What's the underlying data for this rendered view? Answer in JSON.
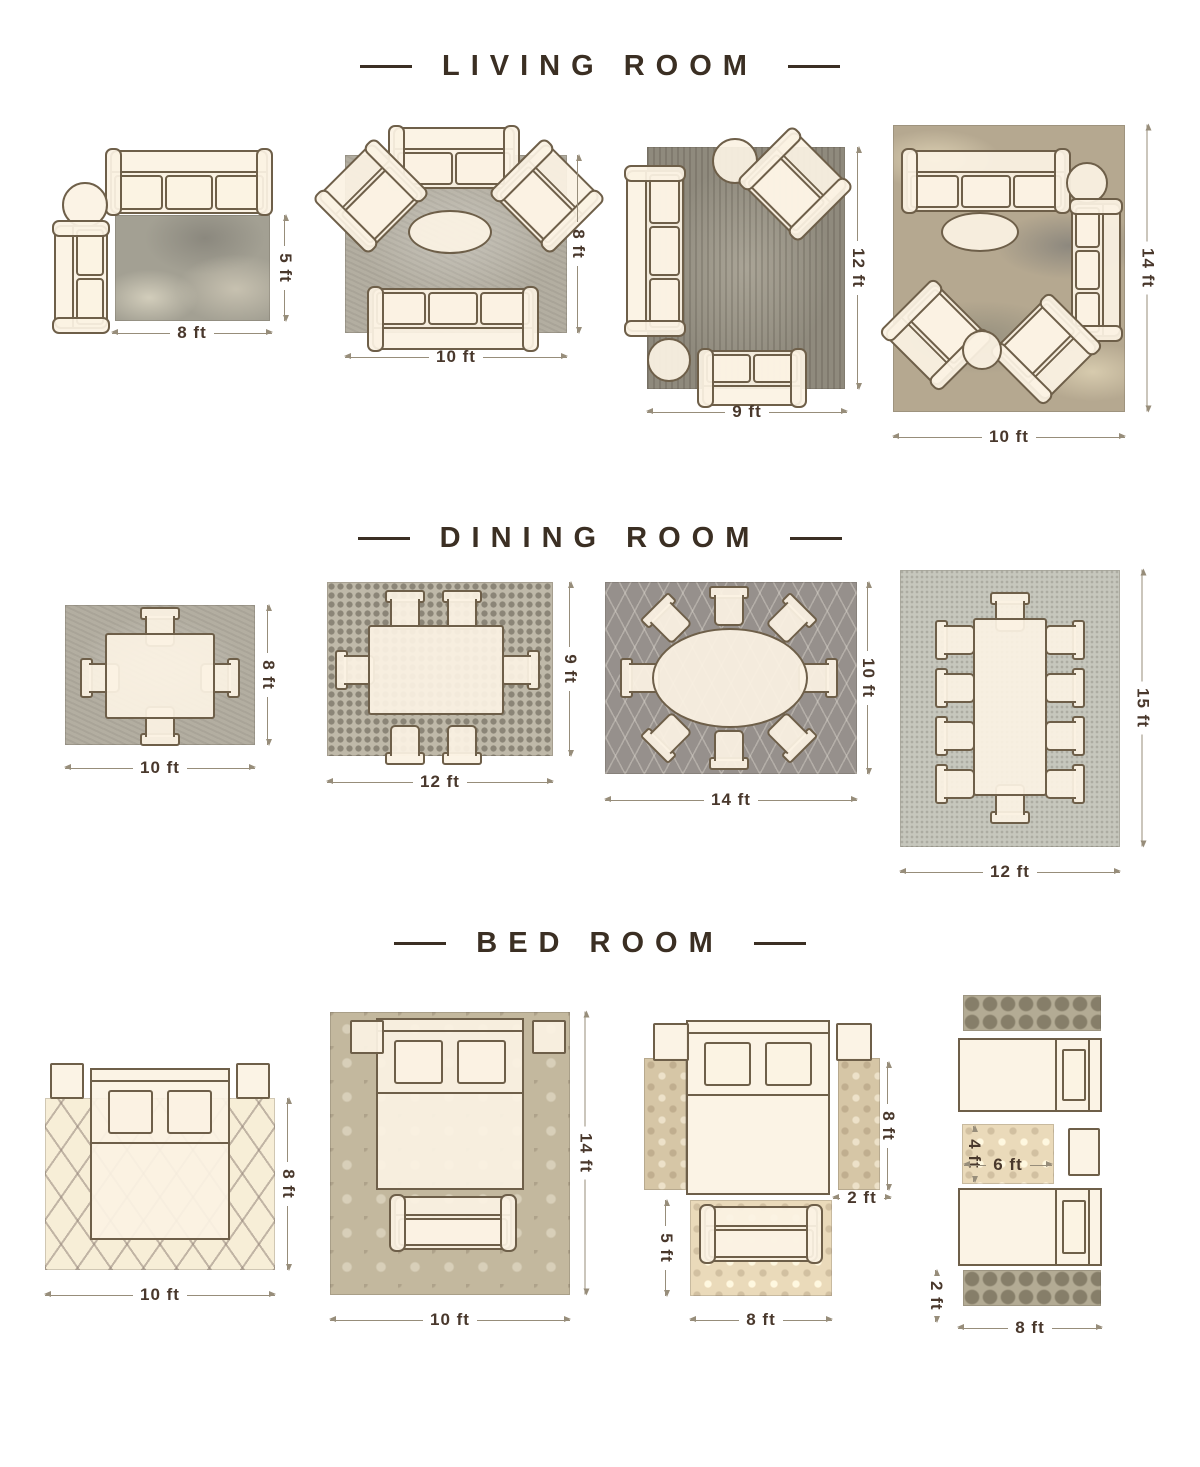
{
  "title": "Rug size guide",
  "colors": {
    "furniture_outline": "#6e5f49",
    "furniture_fill": "#fbf2e3",
    "dimension_text": "#49382c",
    "dimension_line": "#978d7a",
    "title_text": "#3b2f23"
  },
  "sections": [
    {
      "title": "LIVING ROOM",
      "layouts": [
        {
          "name": "living-room-8x5",
          "width_label": "8 ft",
          "height_label": "5 ft",
          "rug": "abstract gray",
          "furniture": [
            "3-seat-sofa",
            "round-accent-table",
            "2-seat-sofa"
          ]
        },
        {
          "name": "living-room-10x8",
          "width_label": "10 ft",
          "height_label": "8 ft",
          "rug": "gray textured",
          "furniture": [
            "2-seat-sofa",
            "armchair",
            "armchair",
            "oval-coffee-table",
            "3-seat-sofa"
          ]
        },
        {
          "name": "living-room-9x12",
          "width_label": "9 ft",
          "height_label": "12 ft",
          "rug": "dark mottled gray",
          "furniture": [
            "3-seat-sofa",
            "round-accent-table",
            "armchair",
            "round-accent-table",
            "2-seat-sofa"
          ]
        },
        {
          "name": "living-room-10x14",
          "width_label": "10 ft",
          "height_label": "14 ft",
          "rug": "abstract tan",
          "furniture": [
            "3-seat-sofa",
            "round-accent-table",
            "3-seat-sofa",
            "oval-coffee-table",
            "armchair",
            "armchair",
            "round-accent-table"
          ]
        }
      ]
    },
    {
      "title": "DINING ROOM",
      "layouts": [
        {
          "name": "dining-room-10x8",
          "width_label": "10 ft",
          "height_label": "8 ft",
          "rug": "gray textured",
          "table": "rectangular",
          "chairs": 4
        },
        {
          "name": "dining-room-12x9",
          "width_label": "12 ft",
          "height_label": "9 ft",
          "rug": "mosaic",
          "table": "rectangular",
          "chairs": 6
        },
        {
          "name": "dining-room-14x10",
          "width_label": "14 ft",
          "height_label": "10 ft",
          "rug": "dark lattice",
          "table": "oval",
          "chairs": 8
        },
        {
          "name": "dining-room-12x15",
          "width_label": "12 ft",
          "height_label": "15 ft",
          "rug": "light speckled",
          "table": "rectangular",
          "chairs": 10
        }
      ]
    },
    {
      "title": "BED ROOM",
      "layouts": [
        {
          "name": "bed-room-10x8",
          "width_label": "10 ft",
          "height_label": "8 ft",
          "rug": "cream diamond",
          "furniture": [
            "nightstand",
            "nightstand",
            "queen-bed"
          ]
        },
        {
          "name": "bed-room-10x14",
          "width_label": "10 ft",
          "height_label": "14 ft",
          "rug": "beige damask",
          "furniture": [
            "nightstand",
            "nightstand",
            "queen-bed",
            "bench-sofa"
          ]
        },
        {
          "name": "bed-room-runners",
          "runner_height_label": "8 ft",
          "runner_width_label": "2 ft",
          "sofa_rug_height_label": "5 ft",
          "sofa_rug_width_label": "8 ft",
          "furniture": [
            "nightstand",
            "nightstand",
            "queen-bed",
            "runner-rug",
            "runner-rug",
            "sofa",
            "accent-rug"
          ]
        },
        {
          "name": "bed-room-twin-beds",
          "accent_rug_height_label": "4 ft",
          "accent_rug_width_label": "6 ft",
          "runner_width_label": "2 ft",
          "runner_length_label": "8 ft",
          "furniture": [
            "runner-rug",
            "twin-bed",
            "accent-rug",
            "nightstand",
            "twin-bed",
            "runner-rug"
          ]
        }
      ]
    }
  ]
}
